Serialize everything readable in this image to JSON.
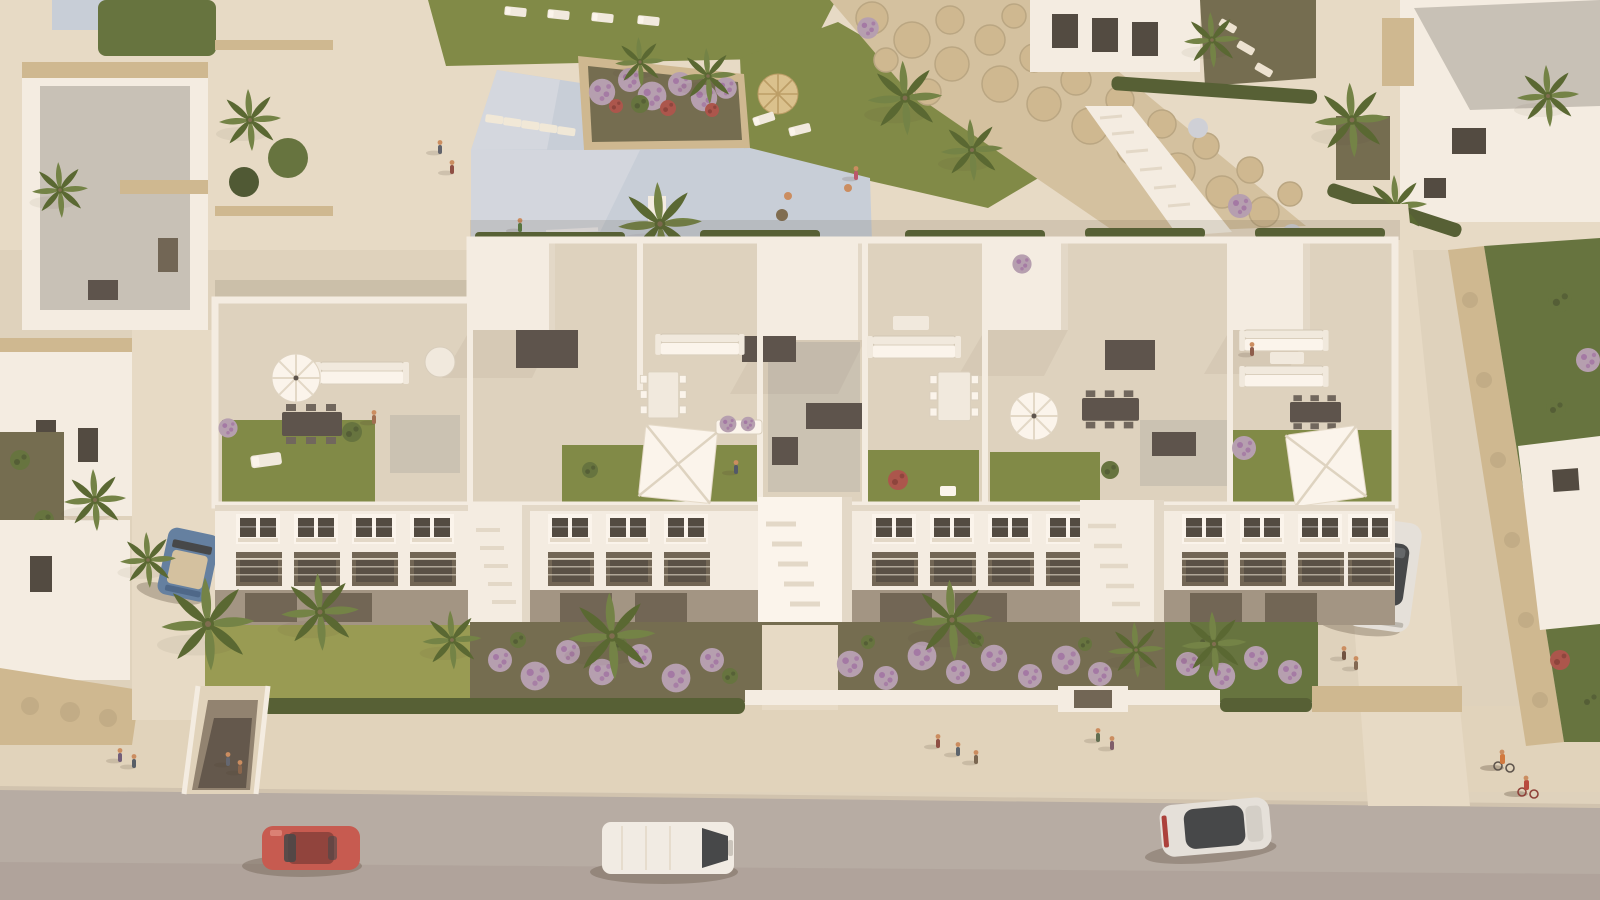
{
  "meta": {
    "description": "Aerial 3D architectural render of a white Mediterranean apartment complex at golden hour: rooftop terraces with lawns, pergolas and umbrellas, a communal beach-entry pool with a flower island, boulder retaining walls, landscaped gardens with purple shrubs and palms, surrounding villas, and a street with cars, pedestrians and cyclists.",
    "image_type": "architectural-render",
    "view": "aerial oblique",
    "visible_text": "none"
  },
  "palette": {
    "pavement": "#ded4c0",
    "plaza": "#e6ddca",
    "sidewalk": "#e0d5bf",
    "road": "#b4aca6",
    "road_dark": "#a59d97",
    "curb": "#cfc5b2",
    "wall_white": "#f4f0e7",
    "wall_bright": "#fbf8f2",
    "wall_shade": "#e2dbcc",
    "facade_shade": "#9f9484",
    "opening": "#6b6254",
    "glass": "#4a463f",
    "roof_terrace": "#ddd4c2",
    "roof_gray": "#c6c2ba",
    "gravel": "#ccc6b9",
    "pebble": "#c9c3b6",
    "lawn": "#7b8845",
    "lawn_dark": "#647233",
    "meadow": "#949a52",
    "foliage": "#5f713d",
    "foliage_dark": "#475531",
    "palm": "#6d8144",
    "palm_dark": "#52652f",
    "hedge": "#4e5c32",
    "stone": "#cdb992",
    "stone_dark": "#b2a07c",
    "sand": "#d2c2a2",
    "purple_bush": "#b39fb3",
    "purple_flower": "#9c6fa4",
    "red_flower": "#a8524a",
    "white_flower": "#cdd2dc",
    "pool": "#c6d0dd",
    "pool_light": "#dde3eb",
    "straw": "#d8c28f",
    "fixture_dark": "#56504a",
    "table_white": "#f1ede3",
    "car_red": "#c4574e",
    "car_blue": "#5d7ea3",
    "van_white": "#f1efe9",
    "car_silver": "#e4e3df",
    "glass_roof": "#3e4347",
    "shadow": "rgba(75,63,48,0.30)",
    "skin": "#c98c5f",
    "orange": "#d0763c",
    "soil": "#6e6a4f",
    "trunk": "#7a6a4e"
  },
  "scene": {
    "areas": [
      "communal pool plaza with stepping stones and flower island",
      "boulder rock retaining wall",
      "three-storey white apartment block with rooftop terraces",
      "rooftop lawns, umbrellas, canopies and pergola boxes",
      "front gardens with purple shrubs, grasses and palms",
      "promenade sidewalk",
      "asphalt road",
      "detached villas left, top and right",
      "side street with parked car",
      "basement garage ramp"
    ],
    "vehicles": [
      {
        "id": "red-car",
        "type": "coupe",
        "color_key": "car_red",
        "location": "road left, facing left"
      },
      {
        "id": "white-van",
        "type": "van",
        "color_key": "van_white",
        "location": "road center, facing right"
      },
      {
        "id": "white-sedan",
        "type": "sedan",
        "color_key": "car_silver",
        "location": "road right, dark glass roof"
      },
      {
        "id": "parked-silver-car",
        "type": "hatchback",
        "color_key": "car_silver",
        "location": "side street right, parked"
      },
      {
        "id": "blue-convertible",
        "type": "convertible",
        "color_key": "car_blue",
        "location": "left driveway under palm"
      }
    ],
    "pool": {
      "water_color_key": "pool",
      "features": [
        "beach entry",
        "stepping stones",
        "stone flower-island planter",
        "entry steps",
        "straw parasol with loungers"
      ],
      "bathers": 2
    },
    "approx_people_visible": 20,
    "rooftop_units": 5,
    "facade_floors": 3,
    "vegetation": [
      "palm trees",
      "purple flowering shrubs",
      "conifer hedges",
      "lawn meadows",
      "bougainvillea",
      "ornamental grasses"
    ]
  }
}
